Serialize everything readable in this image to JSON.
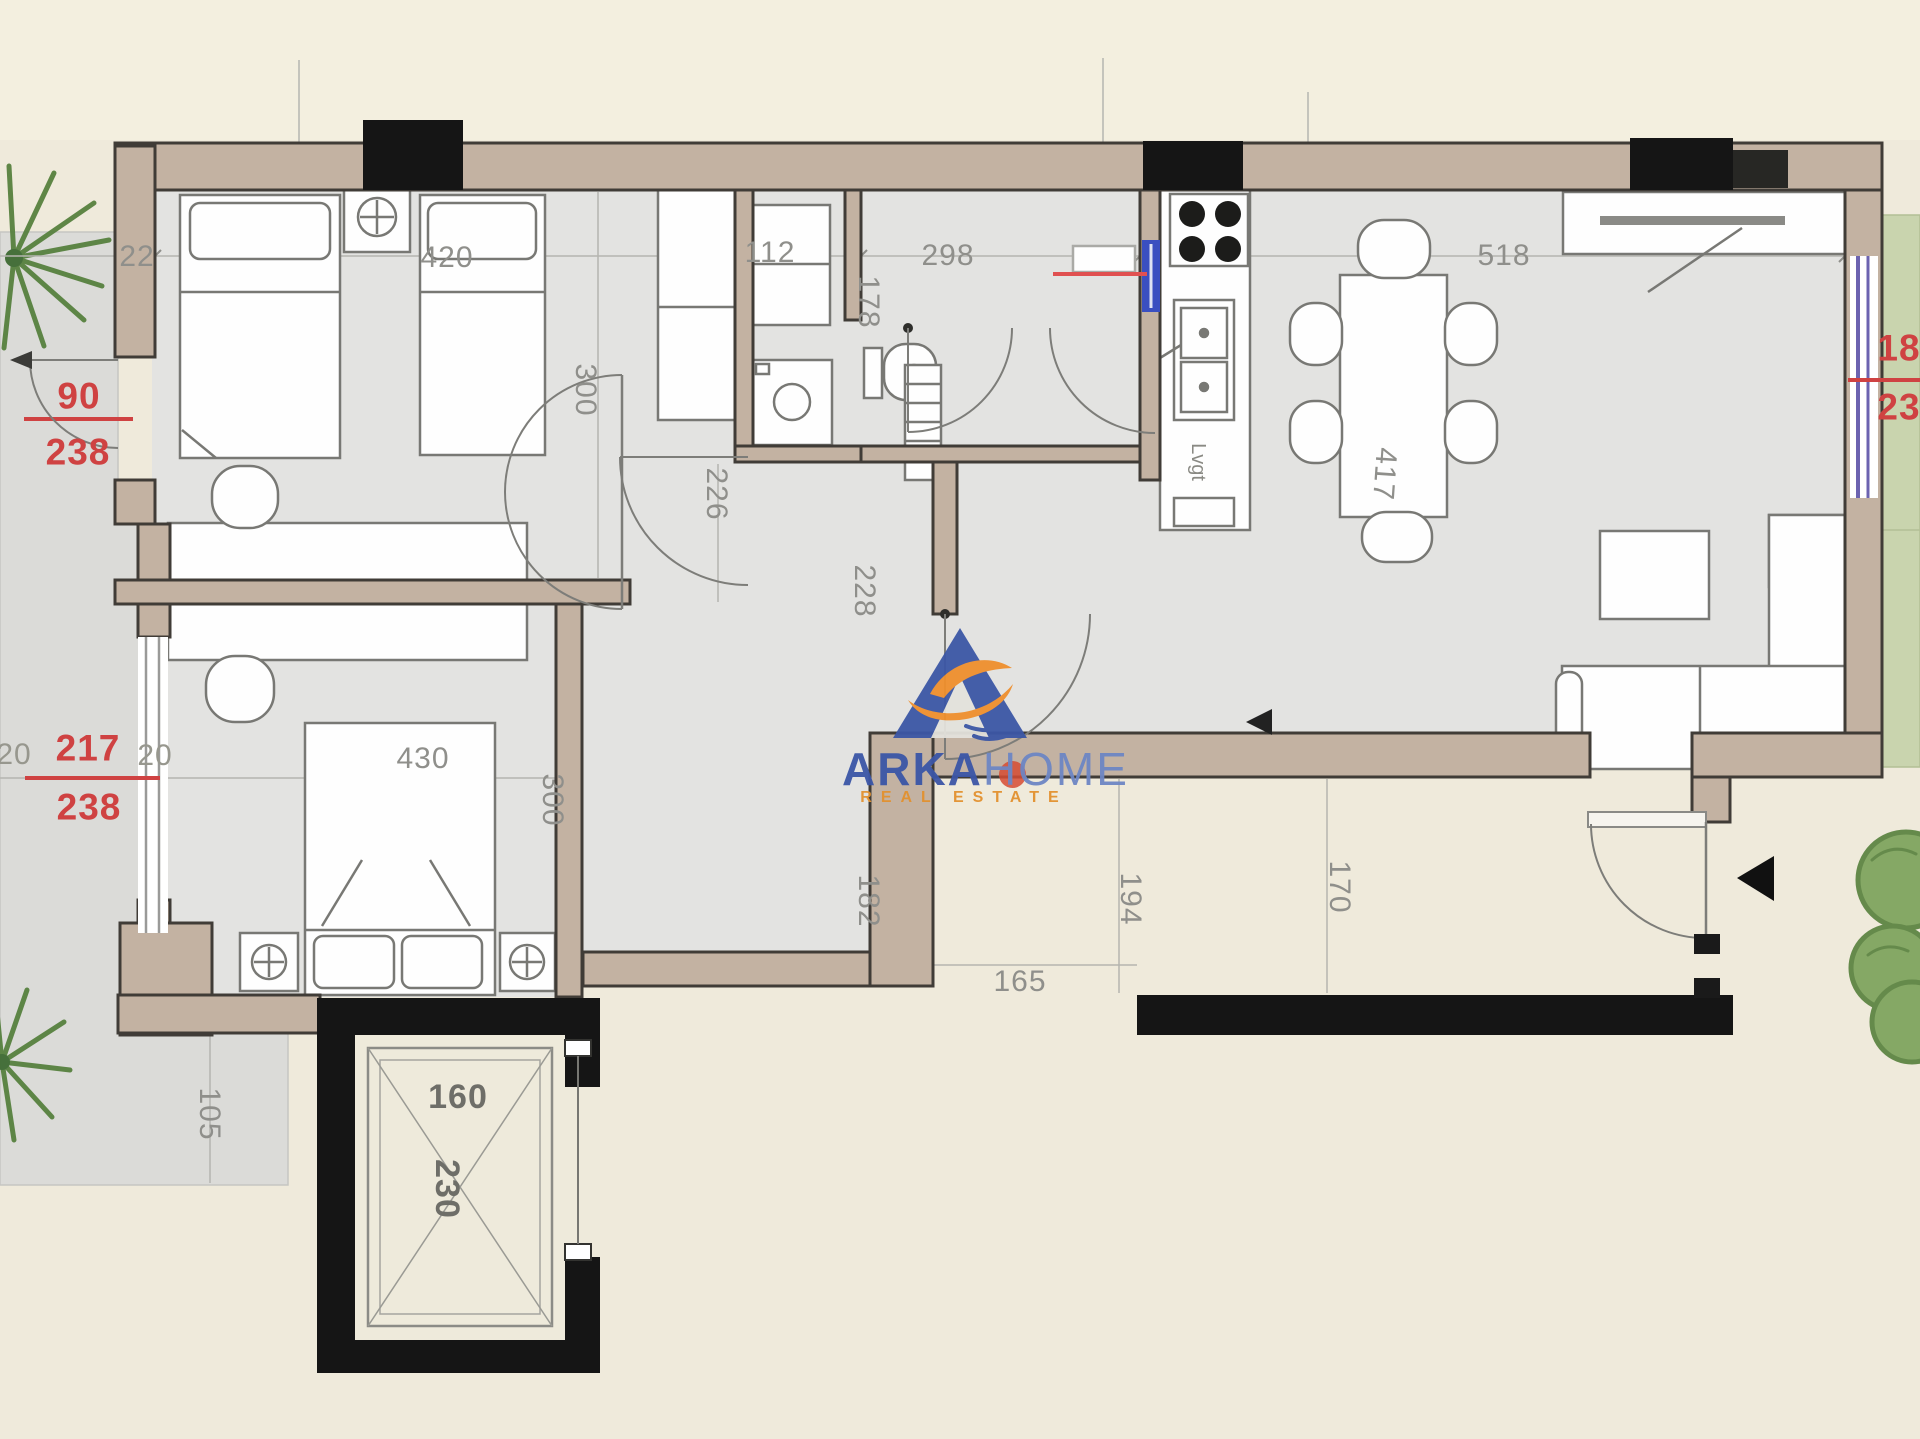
{
  "plan": {
    "type": "apartment-floor-plan",
    "dims_top": {
      "wall": "22",
      "bedroom1_width": "420",
      "bathroom_width": "112",
      "middle_width": "298",
      "living_width": "518"
    },
    "dims_vertical": {
      "bedroom1_depth": "300",
      "bath_depth": "178",
      "corridor_width": "226",
      "hall_depth": "228",
      "bedroom2_depth": "300",
      "hall_lower": "182",
      "entry_left": "194",
      "entry_right": "170",
      "terrace_edge": "105",
      "table": "417"
    },
    "dims_bottom": {
      "opening": "165"
    },
    "shaft": {
      "width": "160",
      "depth": "230"
    },
    "dims_other": {
      "bedroom2_width": "430",
      "kitchen_label": "Lvgt"
    },
    "red_dims_left_door": {
      "width": "90",
      "height": "238"
    },
    "red_dims_left_window": {
      "margin_a": "20",
      "width": "217",
      "height": "238",
      "margin_b": "20"
    },
    "red_dims_right_window": {
      "width": "18",
      "height": "23"
    }
  },
  "watermark": {
    "brand_a": "ARKA",
    "brand_b": "HOME",
    "tagline": "REAL ESTATE",
    "icon": "arka-boat-logo-icon"
  },
  "colors": {
    "background": "#efeadb",
    "wall_tan": "#c3b2a2",
    "wall_outline": "#403c37",
    "structure_black": "#151515",
    "dim_gray": "#8f8f8b",
    "dim_red": "#cf4242",
    "floor_gray": "#e3e3e1",
    "terrace_gray": "#dbdbd8",
    "garden_green": "#c9d4ae",
    "palm_green": "#6d9a52",
    "window_purple": "#6c63b0",
    "window_blue": "#3a4fc0",
    "logo_blue": "#3b56a7",
    "logo_orange": "#ef8f2d"
  }
}
